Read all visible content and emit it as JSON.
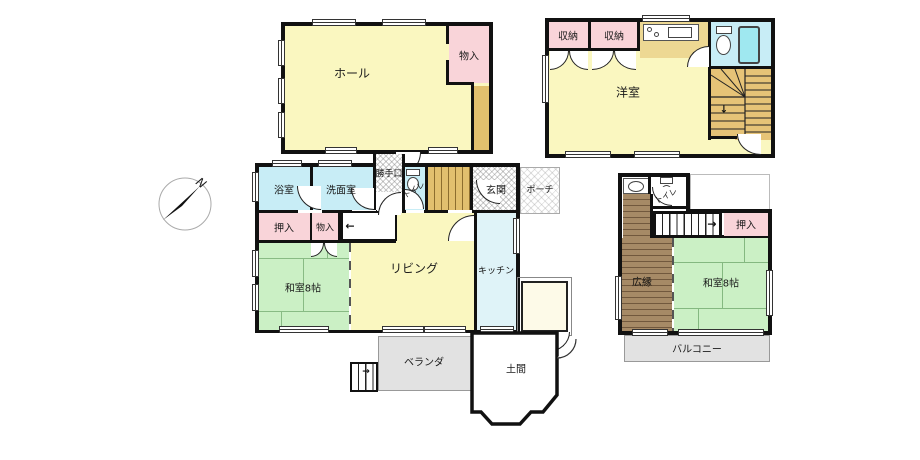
{
  "compass": {
    "north_label": "N"
  },
  "annex": {
    "hall": "ホール",
    "storage": "物入"
  },
  "first_floor": {
    "bath": "浴室",
    "washroom": "洗面室",
    "back_door": "勝手口",
    "toilet": "トイレ",
    "entrance": "玄関",
    "porch": "ポーチ",
    "closet": "押入",
    "storage": "物入",
    "japanese_room": "和室8帖",
    "living": "リビング",
    "kitchen": "キッチン",
    "veranda": "ベランダ",
    "doma": "土間"
  },
  "second_floor_front": {
    "western_room": "洋室",
    "storage_left": "収納",
    "storage_right": "収納"
  },
  "second_floor_rear": {
    "toilet": "トイレ",
    "closet": "押入",
    "hiroen": "広縁",
    "japanese_room": "和室8帖",
    "balcony": "バルコニー"
  },
  "stairs": {
    "down_arrow": "↓",
    "left_arrow": "←",
    "right_arrow": "→",
    "step_arrow": "→"
  },
  "colors": {
    "wall_black": "#111111",
    "room_yellow": "#FAF7C0",
    "closet_pink": "#F9D4D9",
    "wet_cyan": "#C8EDF6",
    "kitchen_cyan": "#DFF3F8",
    "tatami_green": "#CBF0C5",
    "wood_tan": "#E2C06E",
    "stair_tan": "#E6C377",
    "hiroen_brown": "#A68A66",
    "veranda_gray": "#E2E2E2",
    "bathtub_cyan": "#9FE8F0"
  }
}
